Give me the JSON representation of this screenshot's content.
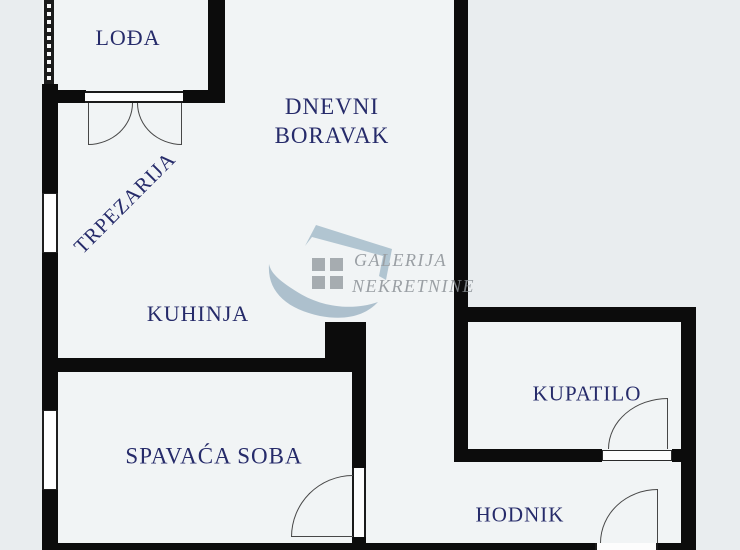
{
  "plan": {
    "type": "apartment-floor-plan",
    "colors": {
      "background": "#e9edef",
      "room_fill": "#f1f4f5",
      "wall": "#0c0c0c",
      "room_label": "#262b6a",
      "door_line": "#474747",
      "watermark_shape": "#a7bdcb",
      "watermark_square": "#9aa0a5",
      "watermark_text": "#8b9196"
    },
    "rooms": [
      {
        "id": "lodja",
        "label": "LOĐA"
      },
      {
        "id": "dnevni-boravak",
        "label": "DNEVNI BORAVAK",
        "lines": [
          "DNEVNI",
          "BORAVAK"
        ]
      },
      {
        "id": "trpezarija",
        "label": "TRPEZARIJA"
      },
      {
        "id": "kuhinja",
        "label": "KUHINJA"
      },
      {
        "id": "spavaca-soba",
        "label": "SPAVAĆA SOBA"
      },
      {
        "id": "kupatilo",
        "label": "KUPATILO"
      },
      {
        "id": "hodnik",
        "label": "HODNIK"
      }
    ],
    "watermark": {
      "line1": "GALERIJA",
      "line2": "NEKRETNINE"
    }
  }
}
